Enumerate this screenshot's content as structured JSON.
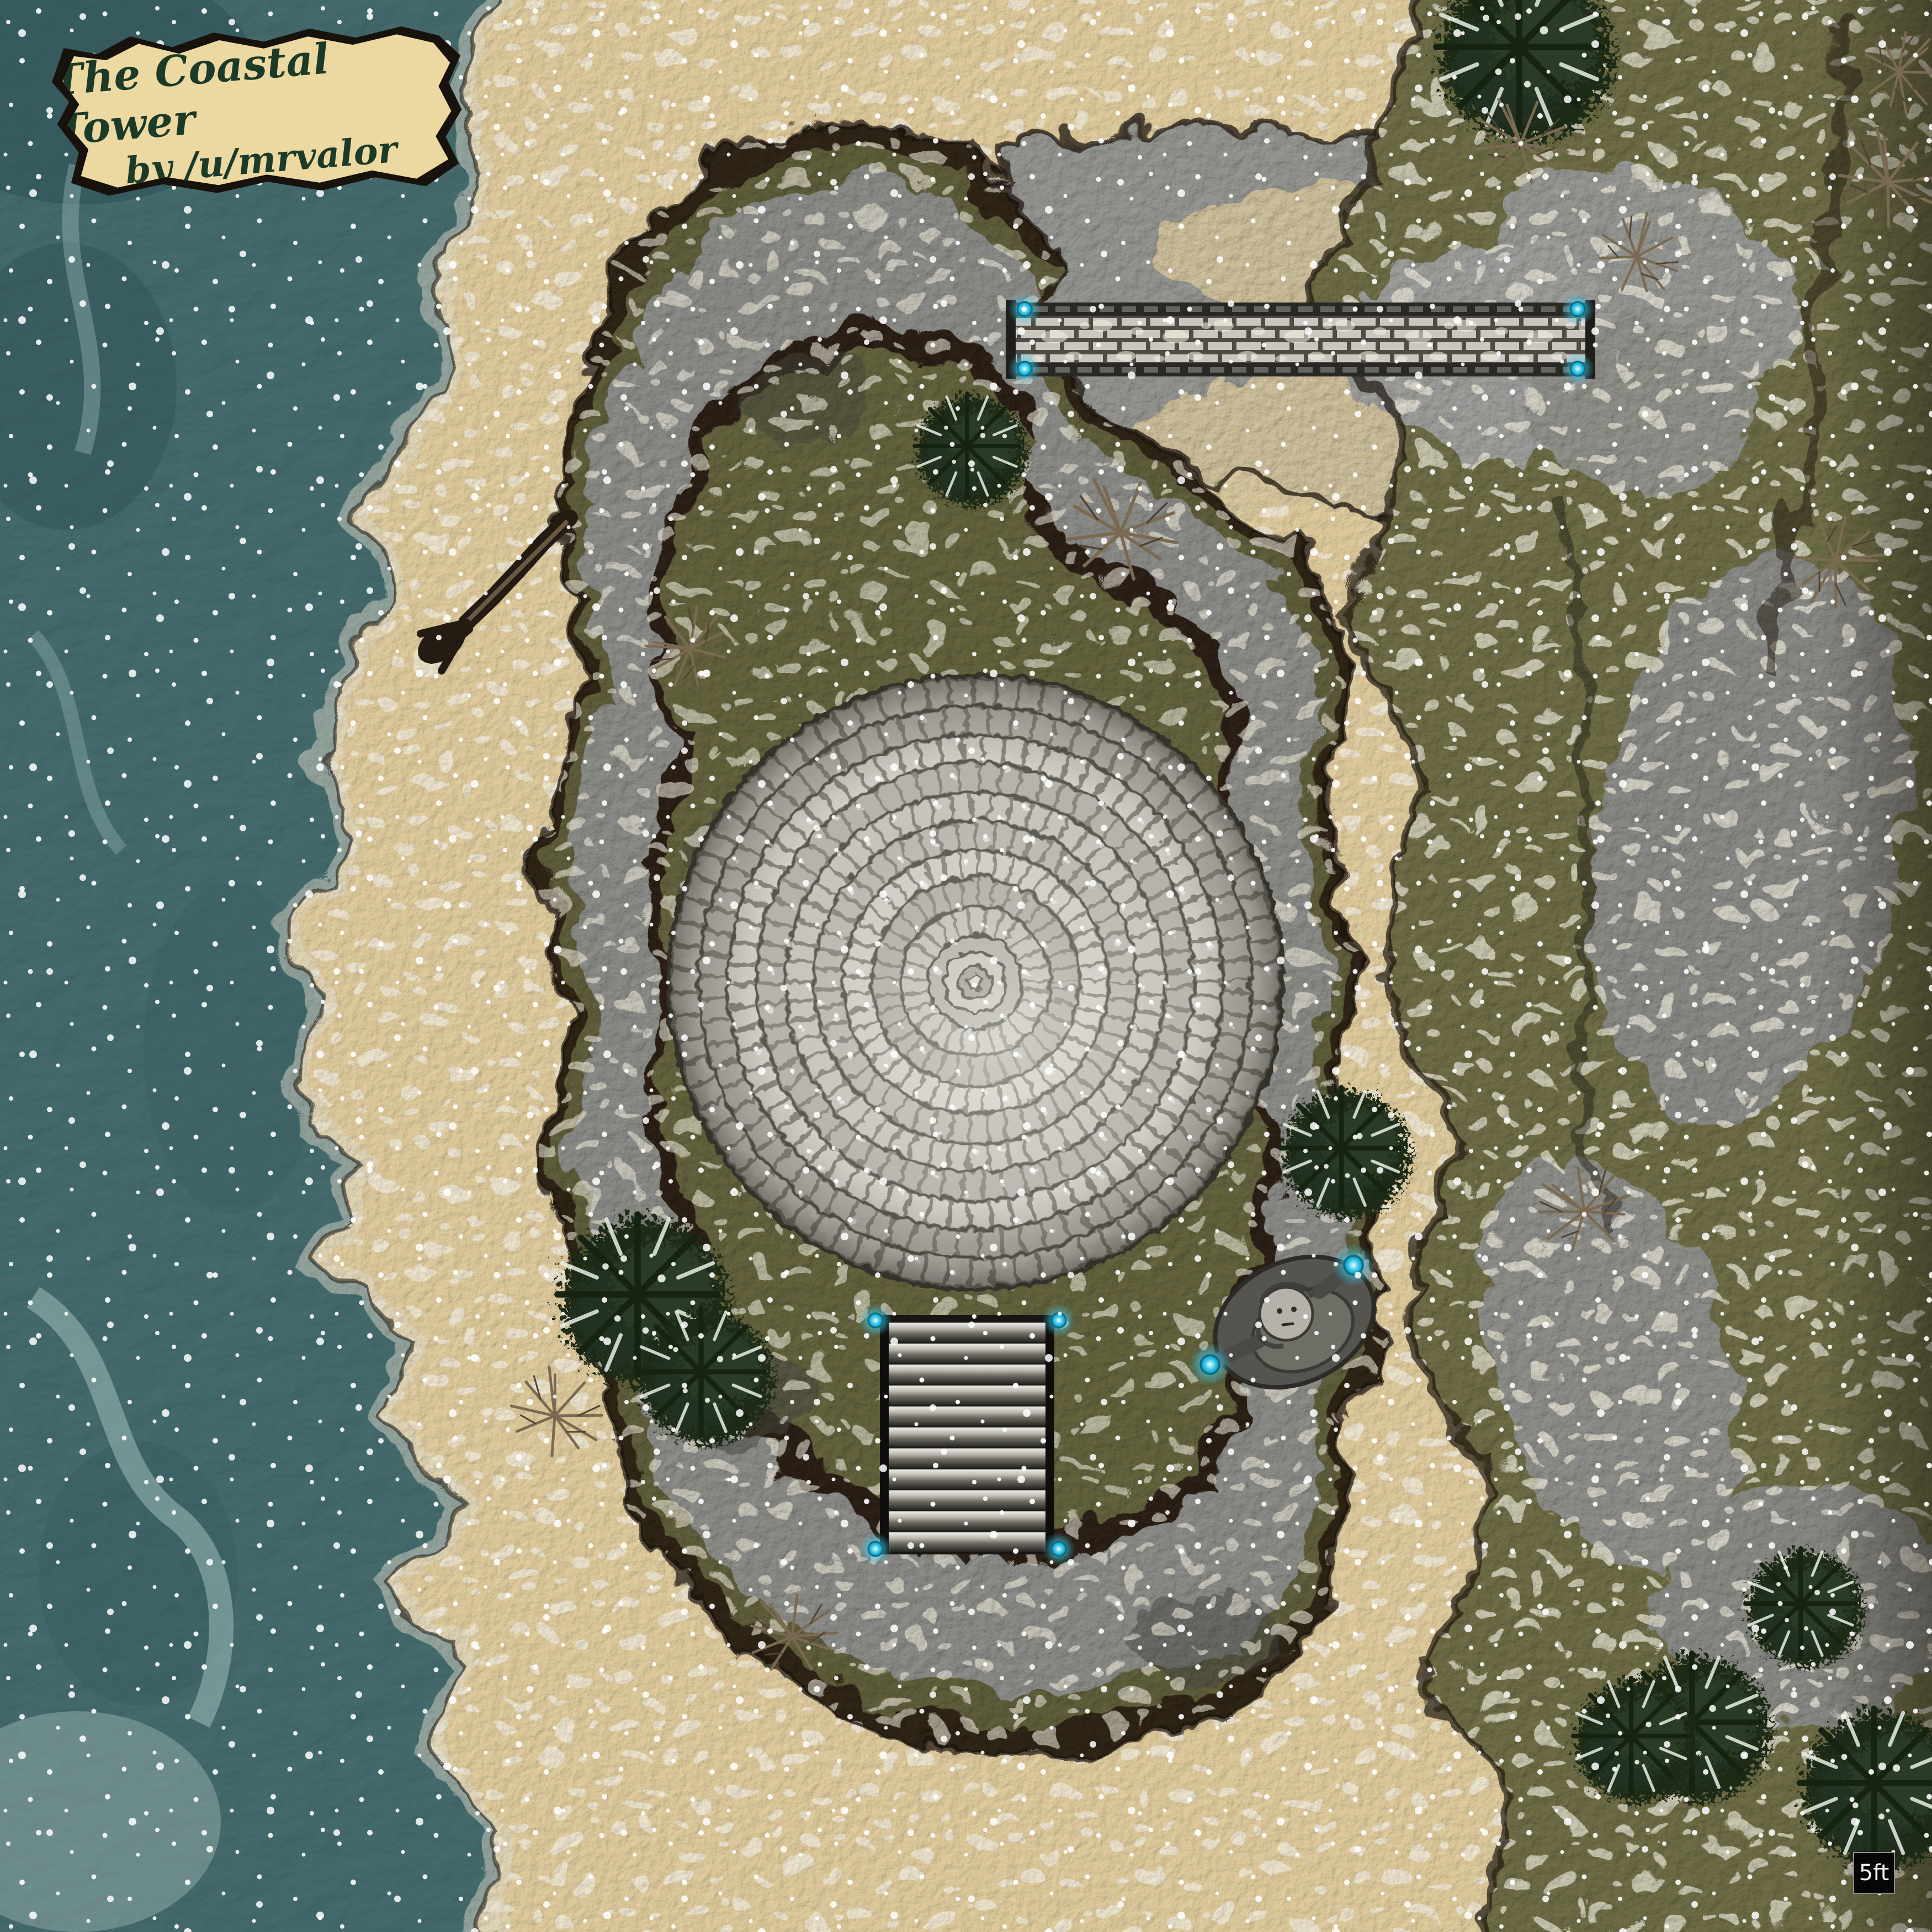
{
  "banner": {
    "title": "The Coastal Tower",
    "byline": "by /u/mrvalor"
  },
  "scale": {
    "label": "5ft"
  },
  "palette": {
    "ocean": "#54767b",
    "ocean_deep": "#2e5156",
    "foam": "#a9c6c2",
    "sand": "#e3cfa0",
    "snow_patch": "#f5f0e1",
    "soil": "#332818",
    "moss": "#72714a",
    "moss_courtyard": "#67663f",
    "rock_grey": "#9a9a96",
    "rock_dark": "#4a4a45",
    "rock_light": "#d8d7d2",
    "tower_stone": "#c8c6be",
    "tower_joint": "#4e4c45",
    "bridge_rail": "#2a2824",
    "step_dark": "#23211d",
    "lantern_core": "#2fc4e8",
    "lantern_glow": "#8ceefc",
    "pine": "#1d2919",
    "pine_frost": "#e8efe6",
    "twig": "#7b6a52",
    "parchment": "#ecd9a2",
    "banner_text": "#1c3a28",
    "scale_bg": "#060606"
  },
  "features": [
    "ocean",
    "sandy-beach",
    "coastline-foam",
    "rocky-island-terraces",
    "cliff-plateau",
    "gorge",
    "coastal-tower-roof",
    "stone-bridge",
    "stone-stairs",
    "statue-with-orbs",
    "glowing-lanterns",
    "snowy-pine-trees",
    "bare-twig-shrubs",
    "driftwood-log",
    "snowfall"
  ]
}
